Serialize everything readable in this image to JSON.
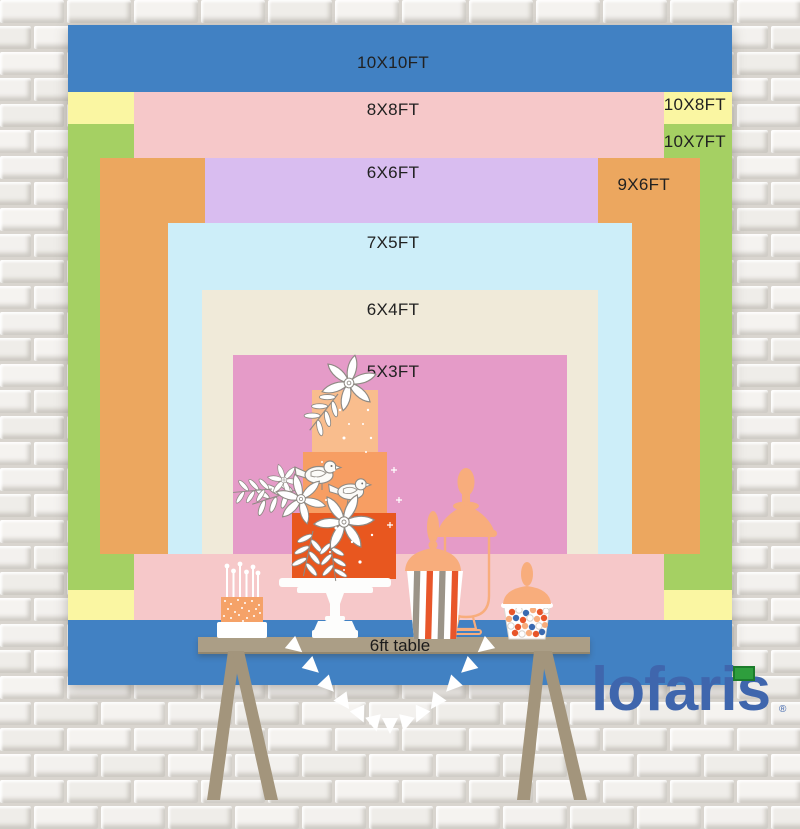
{
  "backdrop": {
    "sizes": [
      {
        "key": "10x10",
        "label": "10X10FT",
        "color": "#4181c3"
      },
      {
        "key": "10x8",
        "label": "10X8FT",
        "color": "#faf6a2"
      },
      {
        "key": "8x8",
        "label": "8X8FT",
        "color": "#f6c8c9"
      },
      {
        "key": "10x7",
        "label": "10X7FT",
        "color": "#a5d063"
      },
      {
        "key": "9x6",
        "label": "9X6FT",
        "color": "#eca75f"
      },
      {
        "key": "6x6",
        "label": "6X6FT",
        "color": "#d9bdf0"
      },
      {
        "key": "7x5",
        "label": "7X5FT",
        "color": "#cdeef9"
      },
      {
        "key": "6x4",
        "label": "6X4FT",
        "color": "#f0ead9"
      },
      {
        "key": "5x3",
        "label": "5X3FT",
        "color": "#e59bc8"
      }
    ]
  },
  "table": {
    "label": "6ft table"
  },
  "brand": {
    "logo_text": "lofaris",
    "registered_mark": "®",
    "logo_color": "#3f66ad",
    "flag_color": "#2e9e3d"
  }
}
